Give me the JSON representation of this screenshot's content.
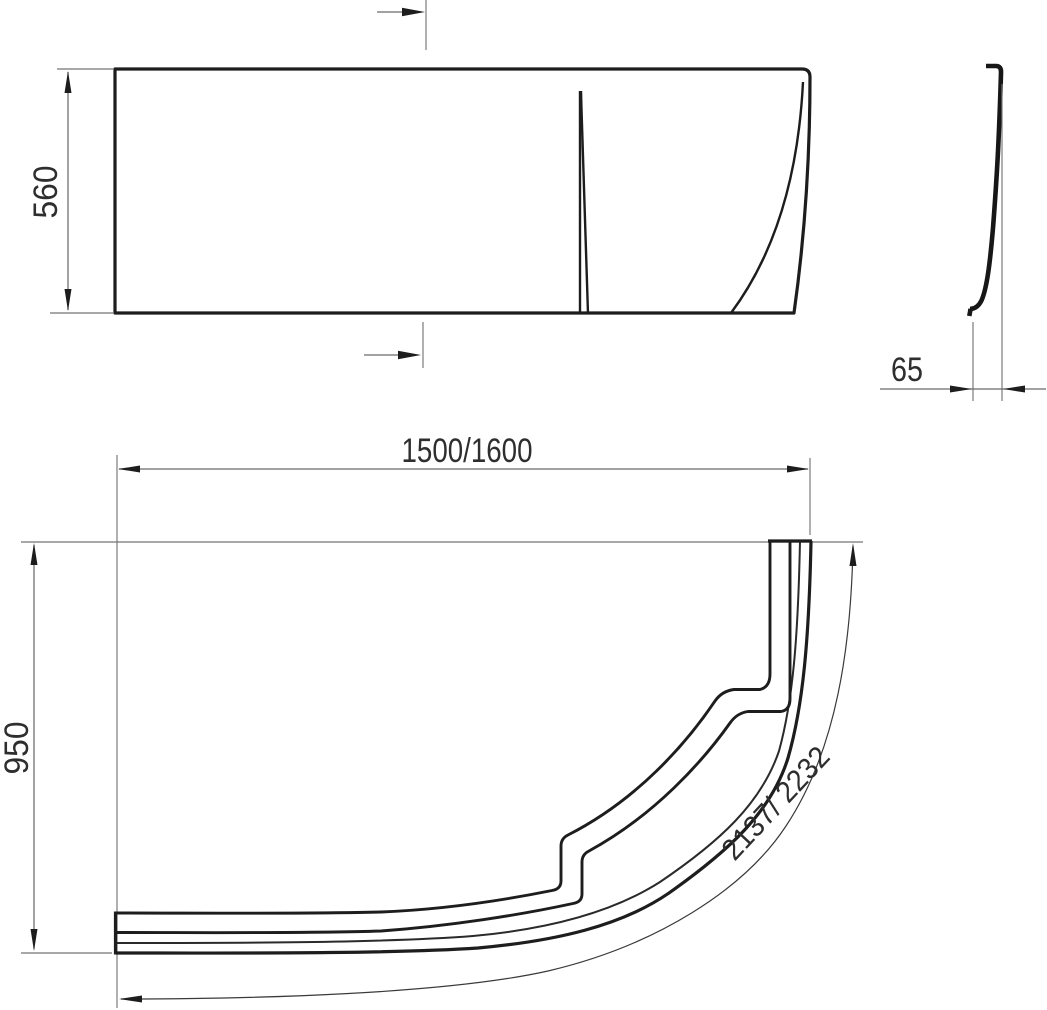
{
  "drawing": {
    "type": "technical-dimension-drawing",
    "subject": "corner bathtub front panel",
    "background_color": "#ffffff",
    "line_color": "#1d1d1d",
    "dimension_line_color": "#6b6b6b",
    "text_color": "#2e2e2e",
    "views": {
      "front_elevation": {
        "description": "rectangular panel elevation with molded seam lines and section-cut arrows",
        "dimensions": {
          "height": {
            "value": "560",
            "orientation": "vertical"
          }
        }
      },
      "side_profile": {
        "description": "thin curved panel cross-section profile",
        "dimensions": {
          "thickness": {
            "value": "65",
            "orientation": "horizontal"
          }
        }
      },
      "plan_view": {
        "description": "quarter-oval curved panel band with two stepped ribs and arc-length dimension",
        "dimensions": {
          "width": {
            "value": "1500/1600",
            "orientation": "horizontal"
          },
          "depth": {
            "value": "950",
            "orientation": "vertical"
          },
          "arc_length": {
            "value": "2137/ 2232",
            "orientation": "along-arc"
          }
        }
      }
    }
  }
}
